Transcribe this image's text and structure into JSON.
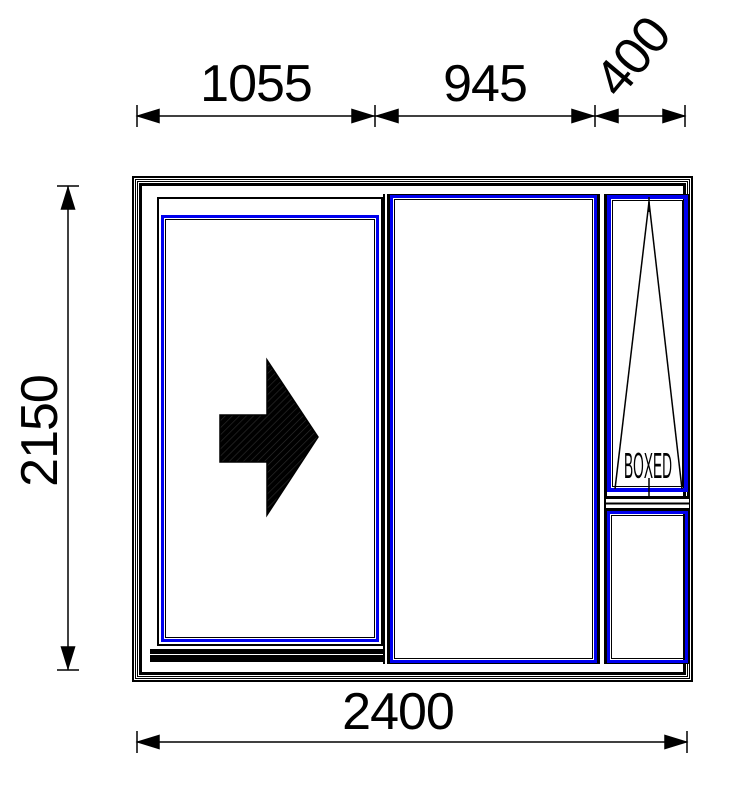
{
  "colors": {
    "line": "#000000",
    "profile_highlight": "#0000ee",
    "background": "#ffffff"
  },
  "dimensions": {
    "top": {
      "segment1": "1055",
      "segment2": "945",
      "segment3": "400"
    },
    "side": {
      "height": "2150"
    },
    "bottom": {
      "total_width": "2400"
    }
  },
  "panels": {
    "awning_label": "BOXED"
  },
  "icons": {
    "slide_direction": "right-arrow-icon",
    "awning_opening": "tilt-opening-triangle-icon"
  }
}
